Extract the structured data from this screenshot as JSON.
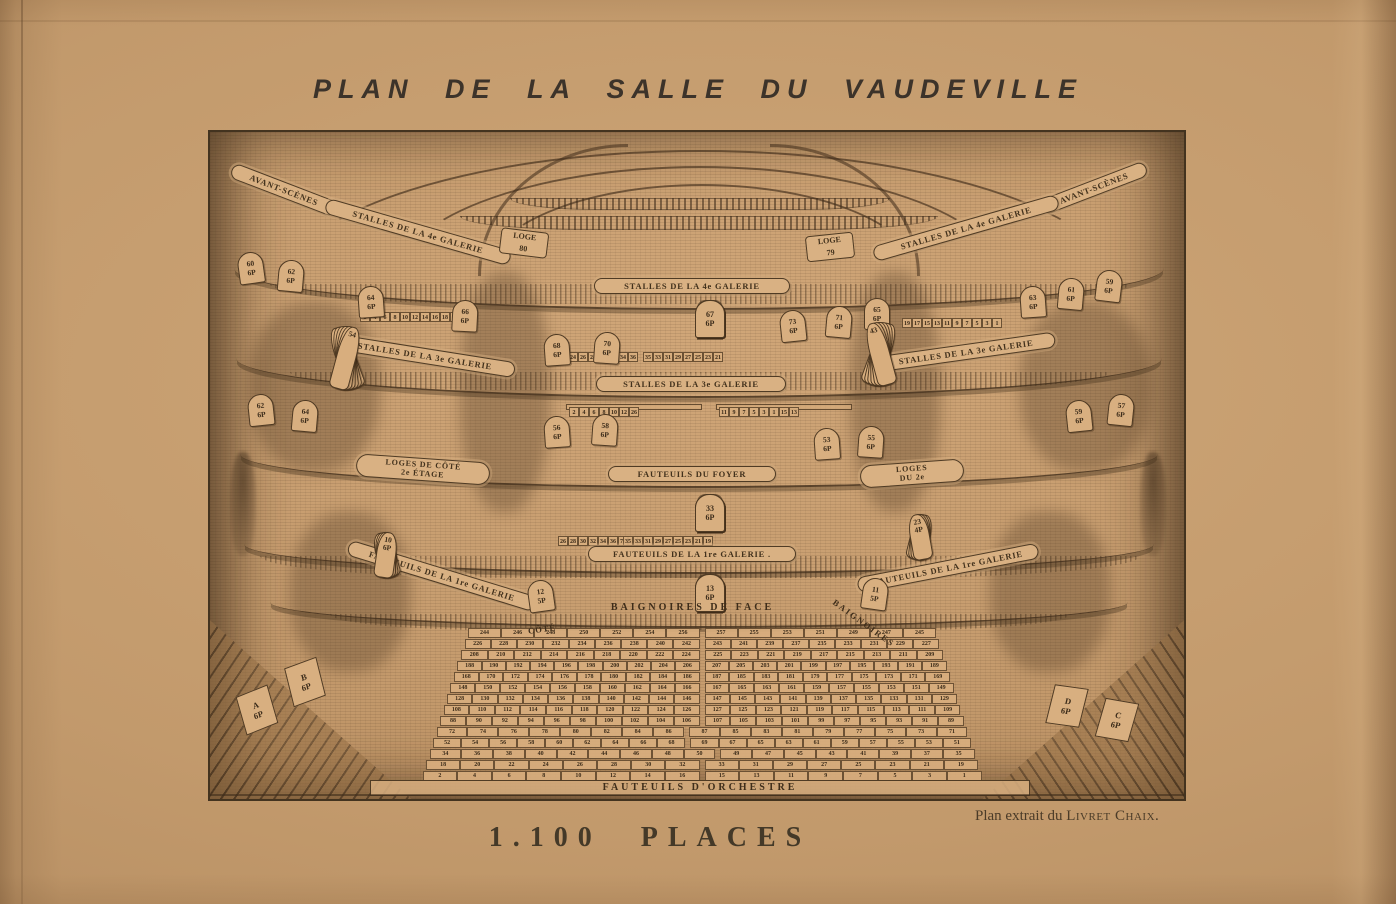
{
  "page": {
    "title": "PLAN DE LA SALLE DU VAUDEVILLE",
    "caption": "1.100  PLACES",
    "credit_prefix": "Plan extrait du ",
    "credit_source": "Livret Chaix",
    "credit_period": ".",
    "paper_color": "#c29a6d",
    "ink_color": "#4a3826"
  },
  "engraving": {
    "banners": {
      "av_l": "AVANT-SCÈNES",
      "av_r": "AVANT-SCÈNES",
      "st4_l": "STALLES DE LA 4e GALERIE",
      "st4_c": "STALLES DE LA 4e GALERIE",
      "st4_r": "STALLES DE LA 4e GALERIE",
      "st3_l": "STALLES DE LA 3e GALERIE",
      "st3_c": "STALLES DE LA 3e GALERIE",
      "st3_r": "STALLES DE LA 3e GALERIE",
      "foyer": "FAUTEUILS DU FOYER",
      "loges_l_1": "LOGES DE CÔTÉ",
      "loges_l_2": "2e ÉTAGE",
      "loges_r_1": "LOGES",
      "loges_r_2": "DU 2e",
      "gal1_c": "FAUTEUILS DE LA 1re GALERIE .",
      "gal1_l": "FAUTEUILS DE LA 1re GALERIE",
      "gal1_r": "FAUTEUILS DE LA 1re GALERIE",
      "baign_face": "BAIGNOIRES   DE   FACE",
      "baign_r": "BAIGNOIRES",
      "cote_l": "CÔTÉ",
      "orchestre": "FAUTEUILS  D'ORCHESTRE"
    },
    "loges": [
      {
        "t": "LOGE",
        "n": "80",
        "x": 290,
        "y": 98,
        "r": 7
      },
      {
        "t": "LOGE",
        "n": "79",
        "x": 596,
        "y": 102,
        "r": -6
      }
    ],
    "stalles4_boxes": [
      "72 6P",
      "74 6P",
      "76 6P",
      "|",
      "71 6P",
      "69 6P",
      "67 6P"
    ],
    "gal4_strips": [
      "54 56 58 60 62 64 66 68 | 67 65 63 61 59 57 55 53",
      "22 24 26 28 30 32 34 36 | 35 33 31 29 27 25 23 21"
    ],
    "wall_grid_left": [
      "34 36 38 40 42 44 46 48 50 52",
      "2 4 6 8 10 12 14 16 18 20"
    ],
    "wall_grid_right": [
      "51 49 47 45 43 41 39 37 35 33",
      "19 17 15 13 11 9 7 5 3 1"
    ],
    "stalles3_left": [
      "42 44 46 48 50 52",
      "28 30 32 34 36 38 40",
      "14 16 18 20 22 24 26",
      "2 4 6 8 10 12"
    ],
    "stalles3_right": [
      "53 51 49 47 45 43",
      "41 39 37 35 33 31 29",
      "27 25 23 21 19 17 15 13",
      "11 9 7 5 3 1"
    ],
    "foyer_boxes": [
      "34 6P",
      "36 6P",
      "38 6P",
      "|",
      "37 6P",
      "35 6P",
      "33 6P"
    ],
    "foyer_strips": [
      "60 62 64 66 68 70 72 74 | 93 91 89 87 85 83 81",
      "26 28 30 32 34 36 | 35 33 31 29 27 25 23 21 19"
    ],
    "gal1_boxes": [
      "14 6P",
      "16 6P",
      "18 6P",
      "|",
      "17 6P",
      "15 6P",
      "13 6P"
    ],
    "orchestra_rows": [
      "244 246 248 250 252 254 256 | 257 255 253 251 249 247 245",
      "226 228 230 232 234 236 238 240 242 | 243 241 239 237 235 233 231 229 227",
      "208 210 212 214 216 218 220 222 224 | 225 223 221 219 217 215 213 211 209",
      "188 190 192 194 196 198 200 202 204 206 | 207 205 203 201 199 197 195 193 191 189",
      "168 170 172 174 176 178 180 182 184 186 | 187 185 183 181 179 177 175 173 171 169",
      "148 150 152 154 156 158 160 162 164 166 | 167 165 163 161 159 157 155 153 151 149",
      "128 130 132 134 136 138 140 142 144 146 | 147 145 143 141 139 137 135 133 131 129",
      "108 110 112 114 116 118 120 122 124 126 | 127 125 123 121 119 117 115 113 111 109",
      "88 90 92 94 96 98 100 102 104 106 | 107 105 103 101 99 97 95 93 91 89",
      "72 74 76 78 80 82 84 86 | 87 85 83 81 79 77 75 73 71",
      "52 54 56 58 60 62 64 66 68 | 69 67 65 63 61 59 57 55 53 51",
      "34 36 38 40 42 44 46 48 50 | 49 47 45 43 41 39 37 35",
      "18 20 22 24 26 28 30 32 | 33 31 29 27 25 23 21 19",
      "2 4 6 8 10 12 14 16 | 15 13 11 9 7 5 3 1"
    ],
    "fans": [
      {
        "name": "fan-seats-left-3e",
        "x": 126,
        "y": 258,
        "h": 64,
        "rot0": -20,
        "step": 7,
        "numbers": [
          "44",
          "46",
          "48",
          "50",
          "52",
          "54"
        ],
        "sub": ""
      },
      {
        "name": "fan-seats-right-3e",
        "x": 660,
        "y": 254,
        "h": 64,
        "rot0": 20,
        "step": -7,
        "numbers": [
          "53",
          "51",
          "49",
          "47",
          "45",
          "43"
        ],
        "sub": ""
      },
      {
        "name": "fan-seats-left-1re",
        "x": 166,
        "y": 446,
        "h": 46,
        "rot0": -16,
        "step": 8,
        "numbers": [
          "4",
          "6",
          "8",
          "10"
        ],
        "sub": "6P"
      },
      {
        "name": "fan-seats-right-1re",
        "x": 700,
        "y": 428,
        "h": 46,
        "rot0": 14,
        "step": -8,
        "numbers": [
          "29",
          "27",
          "25",
          "23"
        ],
        "sub": "4P"
      }
    ],
    "tombstones": [
      {
        "n": "60",
        "p": "6P",
        "x": 28,
        "y": 120,
        "r": -8
      },
      {
        "n": "62",
        "p": "6P",
        "x": 68,
        "y": 128,
        "r": 5
      },
      {
        "n": "64",
        "p": "6P",
        "x": 148,
        "y": 154,
        "r": -4
      },
      {
        "n": "66",
        "p": "6P",
        "x": 242,
        "y": 168,
        "r": 3
      },
      {
        "n": "68",
        "p": "6P",
        "x": 334,
        "y": 202,
        "r": -4
      },
      {
        "n": "70",
        "p": "6P",
        "x": 384,
        "y": 200,
        "r": 4
      },
      {
        "n": "73",
        "p": "6P",
        "x": 570,
        "y": 178,
        "r": -6
      },
      {
        "n": "71",
        "p": "6P",
        "x": 616,
        "y": 174,
        "r": 5
      },
      {
        "n": "65",
        "p": "6P",
        "x": 654,
        "y": 166,
        "r": 0
      },
      {
        "n": "63",
        "p": "6P",
        "x": 810,
        "y": 154,
        "r": -4
      },
      {
        "n": "61",
        "p": "6P",
        "x": 848,
        "y": 146,
        "r": 5
      },
      {
        "n": "59",
        "p": "6P",
        "x": 886,
        "y": 138,
        "r": 7
      },
      {
        "n": "62",
        "p": "6P",
        "x": 38,
        "y": 262,
        "r": -6
      },
      {
        "n": "64",
        "p": "6P",
        "x": 82,
        "y": 268,
        "r": 5
      },
      {
        "n": "56",
        "p": "6P",
        "x": 334,
        "y": 284,
        "r": -4
      },
      {
        "n": "58",
        "p": "6P",
        "x": 382,
        "y": 282,
        "r": 4
      },
      {
        "n": "53",
        "p": "6P",
        "x": 604,
        "y": 296,
        "r": -4
      },
      {
        "n": "55",
        "p": "6P",
        "x": 648,
        "y": 294,
        "r": 4
      },
      {
        "n": "59",
        "p": "6P",
        "x": 856,
        "y": 268,
        "r": -6
      },
      {
        "n": "57",
        "p": "6P",
        "x": 898,
        "y": 262,
        "r": 6
      },
      {
        "n": "12",
        "p": "5P",
        "x": 318,
        "y": 448,
        "r": -8
      },
      {
        "n": "11",
        "p": "5P",
        "x": 652,
        "y": 446,
        "r": 8
      }
    ],
    "corner_boxes": [
      {
        "l": "B",
        "p": "6P",
        "x": 78,
        "y": 530,
        "r": -14
      },
      {
        "l": "A",
        "p": "6P",
        "x": 30,
        "y": 558,
        "r": -16
      },
      {
        "l": "D",
        "p": "6P",
        "x": 840,
        "y": 554,
        "r": 14
      },
      {
        "l": "C",
        "p": "6P",
        "x": 890,
        "y": 568,
        "r": 16
      }
    ]
  }
}
